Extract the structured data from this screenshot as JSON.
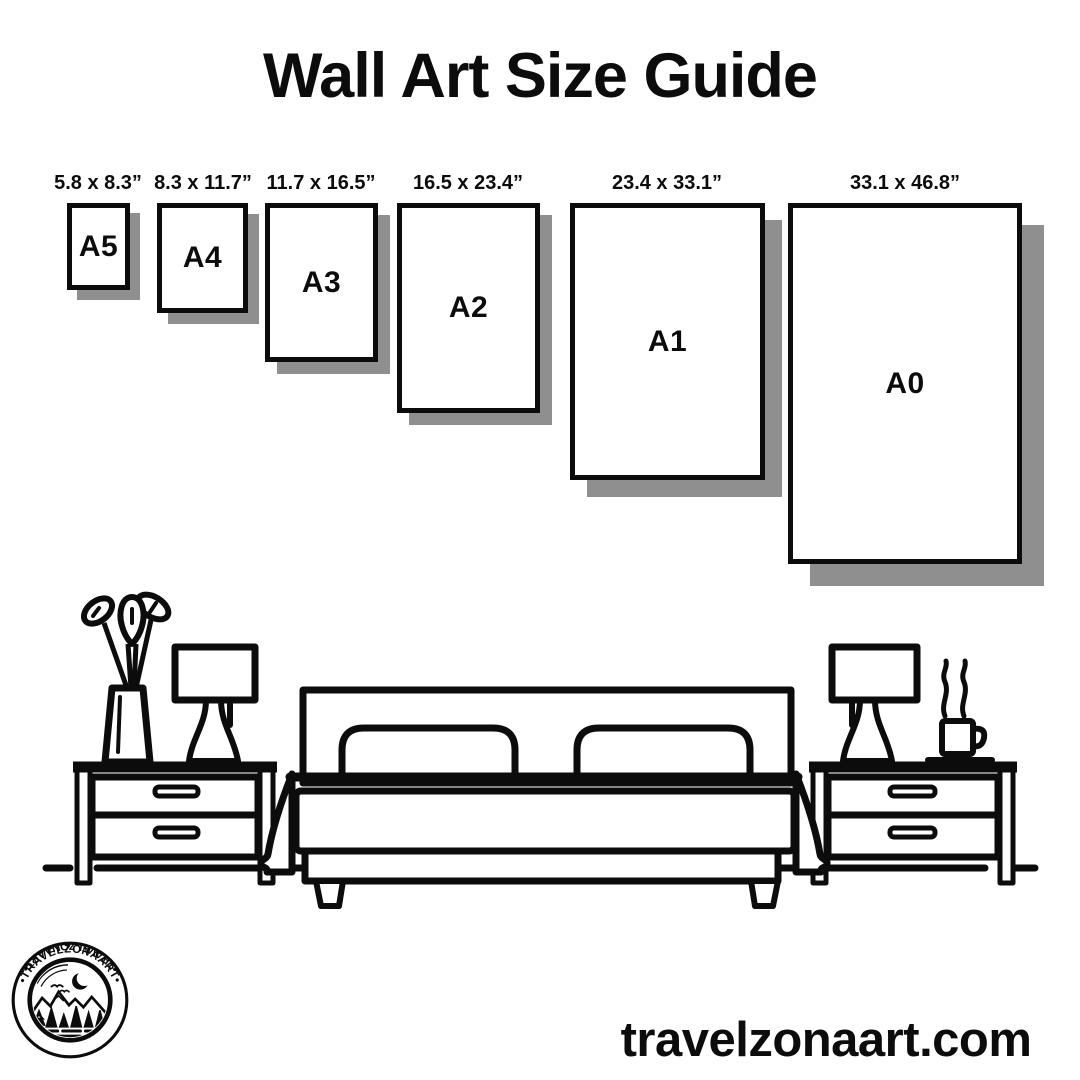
{
  "title": "Wall Art Size Guide",
  "sizes": [
    {
      "name": "A5",
      "dims": "5.8 x 8.3”"
    },
    {
      "name": "A4",
      "dims": "8.3 x 11.7”"
    },
    {
      "name": "A3",
      "dims": "11.7 x 16.5”"
    },
    {
      "name": "A2",
      "dims": "16.5 x 23.4”"
    },
    {
      "name": "A1",
      "dims": "23.4 x 33.1”"
    },
    {
      "name": "A0",
      "dims": "33.1 x 46.8”"
    }
  ],
  "logo": {
    "ring_text_top": "•TRAVELZONAART•",
    "ring_text_bottom": "•TRAVELZONAART•"
  },
  "footer": {
    "website": "travelzonaart.com"
  },
  "colors": {
    "ink": "#0c0c0c",
    "shadow": "#8f8f8f",
    "background": "#ffffff"
  }
}
